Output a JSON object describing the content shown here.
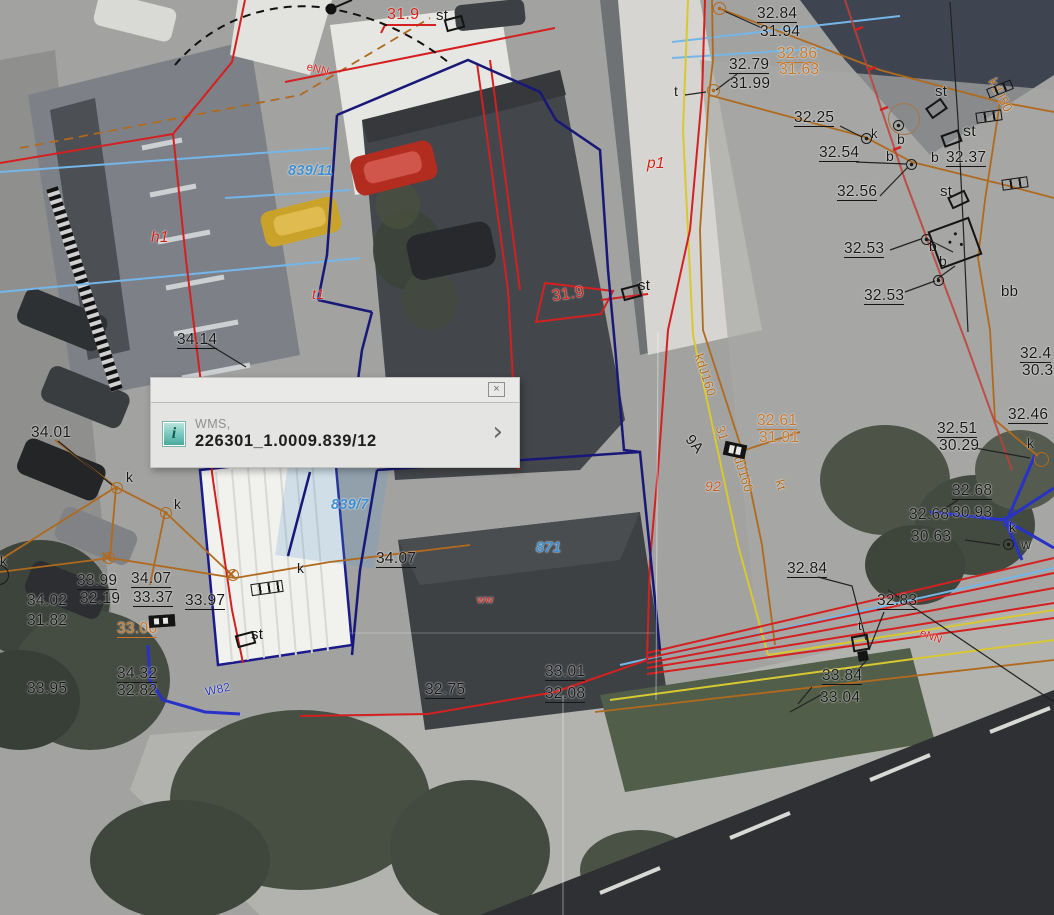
{
  "popup": {
    "source_label": "WMS,",
    "feature_id": "226301_1.0009.839/12",
    "close_glyph": "×",
    "chevron_glyph": "›",
    "info_icon_glyph": "i"
  },
  "map": {
    "palette": {
      "k": "#161616",
      "r": "#d21f15",
      "o": "#b06a1e",
      "ob": "#c4762a",
      "or": "#c85a20",
      "bl": "#3e8ed0",
      "nv": "#2a3ab8"
    },
    "labels": [
      {
        "t": "32.84",
        "x": 757,
        "y": 6,
        "u": 1
      },
      {
        "t": "31.94",
        "x": 760,
        "y": 24
      },
      {
        "t": "32.79",
        "x": 729,
        "y": 57,
        "u": 1
      },
      {
        "t": "31.99",
        "x": 730,
        "y": 76
      },
      {
        "t": "32.86",
        "x": 777,
        "y": 46,
        "c": "ob",
        "u": 1,
        "n": "elevation-label"
      },
      {
        "t": "31.63",
        "x": 779,
        "y": 62,
        "c": "ob"
      },
      {
        "t": "32.25",
        "x": 794,
        "y": 110,
        "u": 1
      },
      {
        "t": "32.54",
        "x": 819,
        "y": 145,
        "u": 1
      },
      {
        "t": "32.37",
        "x": 946,
        "y": 150,
        "u": 1
      },
      {
        "t": "32.56",
        "x": 837,
        "y": 184,
        "u": 1
      },
      {
        "t": "32.53",
        "x": 844,
        "y": 241,
        "u": 1
      },
      {
        "t": "32.53",
        "x": 864,
        "y": 288,
        "u": 1
      },
      {
        "t": "32.4",
        "x": 1020,
        "y": 346,
        "u": 1
      },
      {
        "t": "30.3",
        "x": 1022,
        "y": 363
      },
      {
        "t": "32.46",
        "x": 1008,
        "y": 407,
        "u": 1
      },
      {
        "t": "32.51",
        "x": 937,
        "y": 421,
        "u": 1
      },
      {
        "t": "30.29",
        "x": 939,
        "y": 438
      },
      {
        "t": "32.68",
        "x": 952,
        "y": 483,
        "u": 1
      },
      {
        "t": "32.68",
        "x": 909,
        "y": 507
      },
      {
        "t": "30.93",
        "x": 952,
        "y": 505
      },
      {
        "t": "30.63",
        "x": 911,
        "y": 529
      },
      {
        "t": "34.14",
        "x": 177,
        "y": 332,
        "u": 1
      },
      {
        "t": "34.01",
        "x": 31,
        "y": 425
      },
      {
        "t": "33.99",
        "x": 77,
        "y": 573,
        "u": 1
      },
      {
        "t": "34.07",
        "x": 131,
        "y": 571,
        "u": 1
      },
      {
        "t": "34.02",
        "x": 27,
        "y": 593
      },
      {
        "t": "32.19",
        "x": 80,
        "y": 591
      },
      {
        "t": "33.37",
        "x": 133,
        "y": 590,
        "u": 1
      },
      {
        "t": "33.97",
        "x": 185,
        "y": 593,
        "u": 1
      },
      {
        "t": "31.82",
        "x": 27,
        "y": 613
      },
      {
        "t": "33.06",
        "x": 117,
        "y": 621,
        "c": "ob",
        "u": 1
      },
      {
        "t": "34.32",
        "x": 117,
        "y": 666,
        "u": 1
      },
      {
        "t": "32.82",
        "x": 117,
        "y": 683
      },
      {
        "t": "33.95",
        "x": 27,
        "y": 681
      },
      {
        "t": "34.07",
        "x": 376,
        "y": 551,
        "u": 1
      },
      {
        "t": "33.01",
        "x": 545,
        "y": 664,
        "u": 1
      },
      {
        "t": "32.08",
        "x": 545,
        "y": 686,
        "u": 1
      },
      {
        "t": "32.75",
        "x": 425,
        "y": 682,
        "u": 1
      },
      {
        "t": "32.84",
        "x": 787,
        "y": 561,
        "u": 1
      },
      {
        "t": "32.83",
        "x": 877,
        "y": 593,
        "u": 1
      },
      {
        "t": "33.84",
        "x": 822,
        "y": 668,
        "u": 1
      },
      {
        "t": "33.04",
        "x": 820,
        "y": 690
      },
      {
        "t": "32.61",
        "x": 757,
        "y": 413,
        "c": "ob",
        "u": 1
      },
      {
        "t": "31.91",
        "x": 759,
        "y": 430,
        "c": "ob"
      },
      {
        "t": "t",
        "x": 674,
        "y": 84,
        "s": 14,
        "n": "point-type-label"
      },
      {
        "t": "k",
        "x": 871,
        "y": 127,
        "s": 13,
        "n": "point-type-label"
      },
      {
        "t": "b",
        "x": 897,
        "y": 132,
        "s": 14,
        "n": "point-type-label"
      },
      {
        "t": "st",
        "x": 963,
        "y": 124,
        "s": 16,
        "n": "point-type-label"
      },
      {
        "t": "b",
        "x": 886,
        "y": 149,
        "s": 14,
        "n": "point-type-label"
      },
      {
        "t": "b",
        "x": 931,
        "y": 150,
        "s": 14,
        "n": "point-type-label"
      },
      {
        "t": "st",
        "x": 935,
        "y": 84,
        "s": 15,
        "n": "point-type-label"
      },
      {
        "t": "st",
        "x": 940,
        "y": 184,
        "s": 15,
        "n": "point-type-label"
      },
      {
        "t": "b",
        "x": 929,
        "y": 239,
        "s": 14,
        "n": "point-type-label"
      },
      {
        "t": "b",
        "x": 939,
        "y": 254,
        "s": 14,
        "n": "point-type-label"
      },
      {
        "t": "bb",
        "x": 1001,
        "y": 284,
        "s": 15,
        "n": "point-type-label"
      },
      {
        "t": "k",
        "x": 1027,
        "y": 436,
        "s": 14,
        "n": "point-type-label"
      },
      {
        "t": "k",
        "x": 1009,
        "y": 520,
        "s": 14,
        "n": "point-type-label"
      },
      {
        "t": "w",
        "x": 1021,
        "y": 537,
        "s": 14,
        "n": "point-type-label"
      },
      {
        "t": "k",
        "x": 126,
        "y": 470,
        "s": 14,
        "n": "point-type-label"
      },
      {
        "t": "k",
        "x": 174,
        "y": 497,
        "s": 14,
        "n": "point-type-label"
      },
      {
        "t": "k",
        "x": 0,
        "y": 554,
        "s": 14,
        "n": "point-type-label"
      },
      {
        "t": "k",
        "x": 297,
        "y": 561,
        "s": 14,
        "n": "point-type-label"
      },
      {
        "t": "st",
        "x": 251,
        "y": 627,
        "s": 15,
        "n": "point-type-label"
      },
      {
        "t": "st",
        "x": 638,
        "y": 278,
        "s": 15,
        "n": "point-type-label"
      },
      {
        "t": "st",
        "x": 436,
        "y": 8,
        "s": 15,
        "n": "point-type-label"
      },
      {
        "t": "t",
        "x": 858,
        "y": 619,
        "s": 13,
        "n": "point-type-label"
      },
      {
        "t": "9A",
        "x": 694,
        "y": 432,
        "s": 15,
        "r": 50,
        "n": "address-label"
      },
      {
        "t": "31.9",
        "x": 387,
        "y": 7,
        "c": "r",
        "s": 16,
        "n": "red-elevation-label"
      },
      {
        "t": "31.9",
        "x": 551,
        "y": 289,
        "c": "r",
        "s": 16,
        "r": -8,
        "n": "red-elevation-label"
      },
      {
        "t": "h1",
        "x": 151,
        "y": 230,
        "c": "r",
        "i": 1,
        "n": "building-label"
      },
      {
        "t": "p1",
        "x": 647,
        "y": 156,
        "c": "r",
        "i": 1,
        "n": "building-label"
      },
      {
        "t": "t1",
        "x": 312,
        "y": 287,
        "c": "r",
        "i": 1,
        "s": 14,
        "n": "building-label"
      },
      {
        "t": "92",
        "x": 705,
        "y": 479,
        "c": "or",
        "s": 14,
        "i": 1,
        "n": "building-label"
      },
      {
        "t": "ww",
        "x": 477,
        "y": 595,
        "c": "r",
        "s": 11,
        "n": "building-label"
      },
      {
        "t": "eNN",
        "x": 308,
        "y": 62,
        "c": "r",
        "s": 11,
        "r": 14,
        "n": "utility-label"
      },
      {
        "t": "eNN",
        "x": 922,
        "y": 628,
        "c": "r",
        "s": 11,
        "r": 20,
        "n": "utility-label"
      },
      {
        "t": "kdJ160",
        "x": 705,
        "y": 352,
        "c": "o",
        "s": 13,
        "r": 72,
        "n": "utility-label"
      },
      {
        "t": "31",
        "x": 726,
        "y": 424,
        "c": "o",
        "s": 13,
        "r": 72,
        "n": "utility-label"
      },
      {
        "t": "kdJ160",
        "x": 742,
        "y": 448,
        "c": "o",
        "s": 13,
        "r": 72,
        "n": "utility-label"
      },
      {
        "t": "kt",
        "x": 786,
        "y": 478,
        "c": "o",
        "s": 13,
        "r": 75,
        "n": "utility-label"
      },
      {
        "t": "kdJ50",
        "x": 998,
        "y": 76,
        "c": "o",
        "s": 13,
        "r": 62,
        "n": "utility-label"
      },
      {
        "t": "839/11",
        "x": 288,
        "y": 164,
        "c": "bl",
        "s": 14.5,
        "i": 1,
        "b": 1,
        "n": "parcel-number-label"
      },
      {
        "t": "839/7",
        "x": 331,
        "y": 498,
        "c": "bl",
        "s": 14.5,
        "i": 1,
        "b": 1,
        "n": "parcel-number-label"
      },
      {
        "t": "871",
        "x": 536,
        "y": 541,
        "c": "bl",
        "s": 14.5,
        "i": 1,
        "b": 1,
        "n": "parcel-number-label"
      },
      {
        "t": "W82",
        "x": 204,
        "y": 686,
        "c": "nv",
        "s": 12,
        "r": -12,
        "n": "utility-label"
      }
    ],
    "symbols": [
      {
        "k": "ringdot",
        "x": 865,
        "y": 137,
        "d": 9
      },
      {
        "k": "ringdot",
        "x": 910,
        "y": 163,
        "d": 9
      },
      {
        "k": "ringdot",
        "x": 925,
        "y": 238,
        "d": 9
      },
      {
        "k": "ringdot",
        "x": 937,
        "y": 279,
        "d": 9
      },
      {
        "k": "ringdot",
        "x": 1007,
        "y": 543,
        "d": 9
      },
      {
        "k": "ringdot",
        "x": 897,
        "y": 124,
        "d": 9
      },
      {
        "k": "ring",
        "x": 903,
        "y": 118,
        "d": 30,
        "c": "#a3774a"
      },
      {
        "k": "ringdot",
        "x": 718,
        "y": 7,
        "d": 11,
        "c": "#b06a1e"
      },
      {
        "k": "ringdot",
        "x": 712,
        "y": 89,
        "d": 11,
        "c": "#b06a1e"
      },
      {
        "k": "ringdot",
        "x": 116,
        "y": 487,
        "d": 10,
        "c": "#b06a1e"
      },
      {
        "k": "ringdot",
        "x": 165,
        "y": 512,
        "d": 10,
        "c": "#b06a1e"
      },
      {
        "k": "ring",
        "x": 1040,
        "y": 458,
        "d": 13,
        "c": "#b06a1e"
      },
      {
        "k": "ring",
        "x": -2,
        "y": 574,
        "d": 18
      },
      {
        "k": "ringdot",
        "x": 1005,
        "y": 520,
        "d": 9,
        "c": "#2a3ab8"
      },
      {
        "k": "rect",
        "x": 629,
        "y": 290,
        "w": 15,
        "h": 9,
        "r": -15
      },
      {
        "k": "rect",
        "x": 452,
        "y": 21,
        "w": 15,
        "h": 9,
        "r": -15
      },
      {
        "k": "rect",
        "x": 934,
        "y": 106,
        "w": 15,
        "h": 9,
        "r": -35
      },
      {
        "k": "rect",
        "x": 949,
        "y": 136,
        "w": 15,
        "h": 9,
        "r": -20
      },
      {
        "k": "rect",
        "x": 956,
        "y": 197,
        "w": 15,
        "h": 9,
        "r": -25
      },
      {
        "k": "rect",
        "x": 243,
        "y": 637,
        "w": 15,
        "h": 9,
        "r": -15
      },
      {
        "k": "rect",
        "x": 858,
        "y": 641,
        "w": 13,
        "h": 12,
        "r": -10
      },
      {
        "k": "sq",
        "x": 863,
        "y": 656,
        "w": 10,
        "h": 10,
        "r": -10
      },
      {
        "k": "chain",
        "x": 988,
        "y": 115,
        "w": 24,
        "h": 9,
        "r": -8
      },
      {
        "k": "chain",
        "x": 1014,
        "y": 182,
        "w": 24,
        "h": 9,
        "r": -8
      },
      {
        "k": "chain",
        "x": 266,
        "y": 587,
        "w": 30,
        "h": 10,
        "r": -8
      },
      {
        "k": "chain",
        "x": 999,
        "y": 88,
        "w": 24,
        "h": 8,
        "r": -22
      },
      {
        "k": "cab",
        "x": 734,
        "y": 449,
        "w": 20,
        "h": 12,
        "r": 12
      },
      {
        "k": "cab",
        "x": 161,
        "y": 620,
        "w": 24,
        "h": 10,
        "r": -4
      },
      {
        "k": "transformer",
        "x": 953,
        "y": 241,
        "w": 40,
        "h": 36,
        "r": -20
      },
      {
        "k": "pole",
        "x": 108,
        "y": 557
      },
      {
        "k": "pole",
        "x": 232,
        "y": 574
      }
    ]
  }
}
